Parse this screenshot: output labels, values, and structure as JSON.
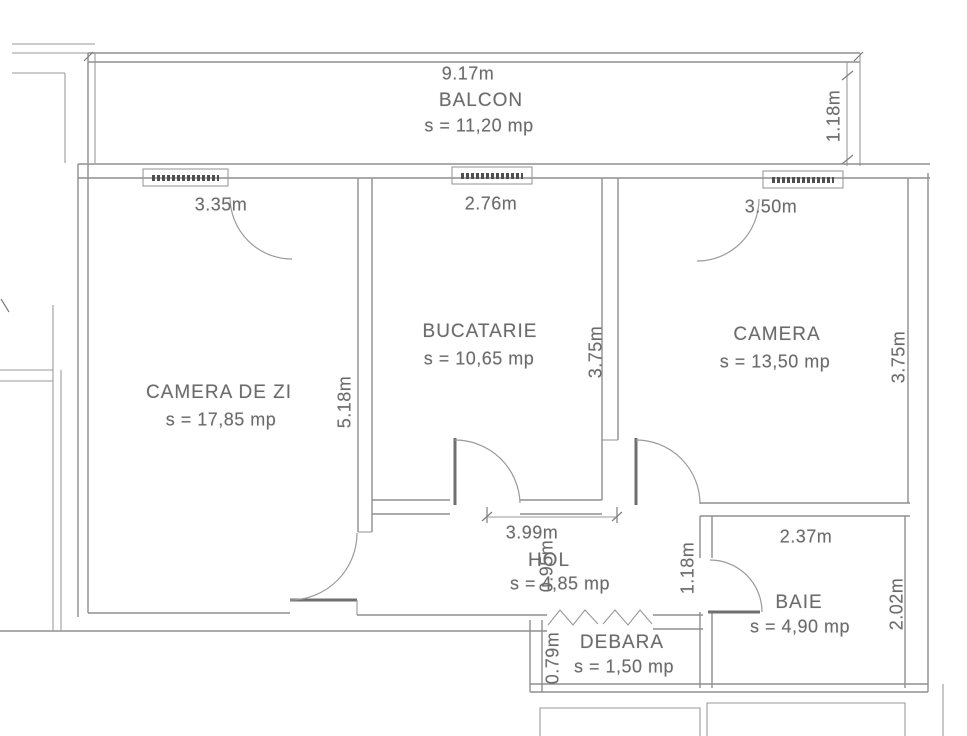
{
  "rooms": {
    "balcon": {
      "name": "BALCON",
      "area": "s = 11,20 mp"
    },
    "camera_de_zi": {
      "name": "CAMERA DE ZI",
      "area": "s = 17,85 mp"
    },
    "bucatarie": {
      "name": "BUCATARIE",
      "area": "s = 10,65 mp"
    },
    "camera": {
      "name": "CAMERA",
      "area": "s = 13,50 mp"
    },
    "hol": {
      "name": "HOL",
      "area": "s = 4,85 mp"
    },
    "baie": {
      "name": "BAIE",
      "area": "s = 4,90 mp"
    },
    "debara": {
      "name": "DEBARA",
      "area": "s = 1,50 mp"
    }
  },
  "dimensions": {
    "balcon_width": "9.17m",
    "balcon_depth": "1.18m",
    "camera_de_zi_window": "3.35m",
    "camera_de_zi_depth": "5.18m",
    "bucatarie_window": "2.76m",
    "bucatarie_depth": "3.75m",
    "camera_window": "3.50m",
    "camera_depth": "3.75m",
    "hol_width": "3.99m",
    "hol_passage": "0.95m",
    "hol_depth": "1.18m",
    "baie_width": "2.37m",
    "baie_depth": "2.02m",
    "debara_depth": "0.79m"
  },
  "colors": {
    "ink": "#6b6b6b",
    "wall": "#8f8f8f",
    "background": "#ffffff"
  }
}
